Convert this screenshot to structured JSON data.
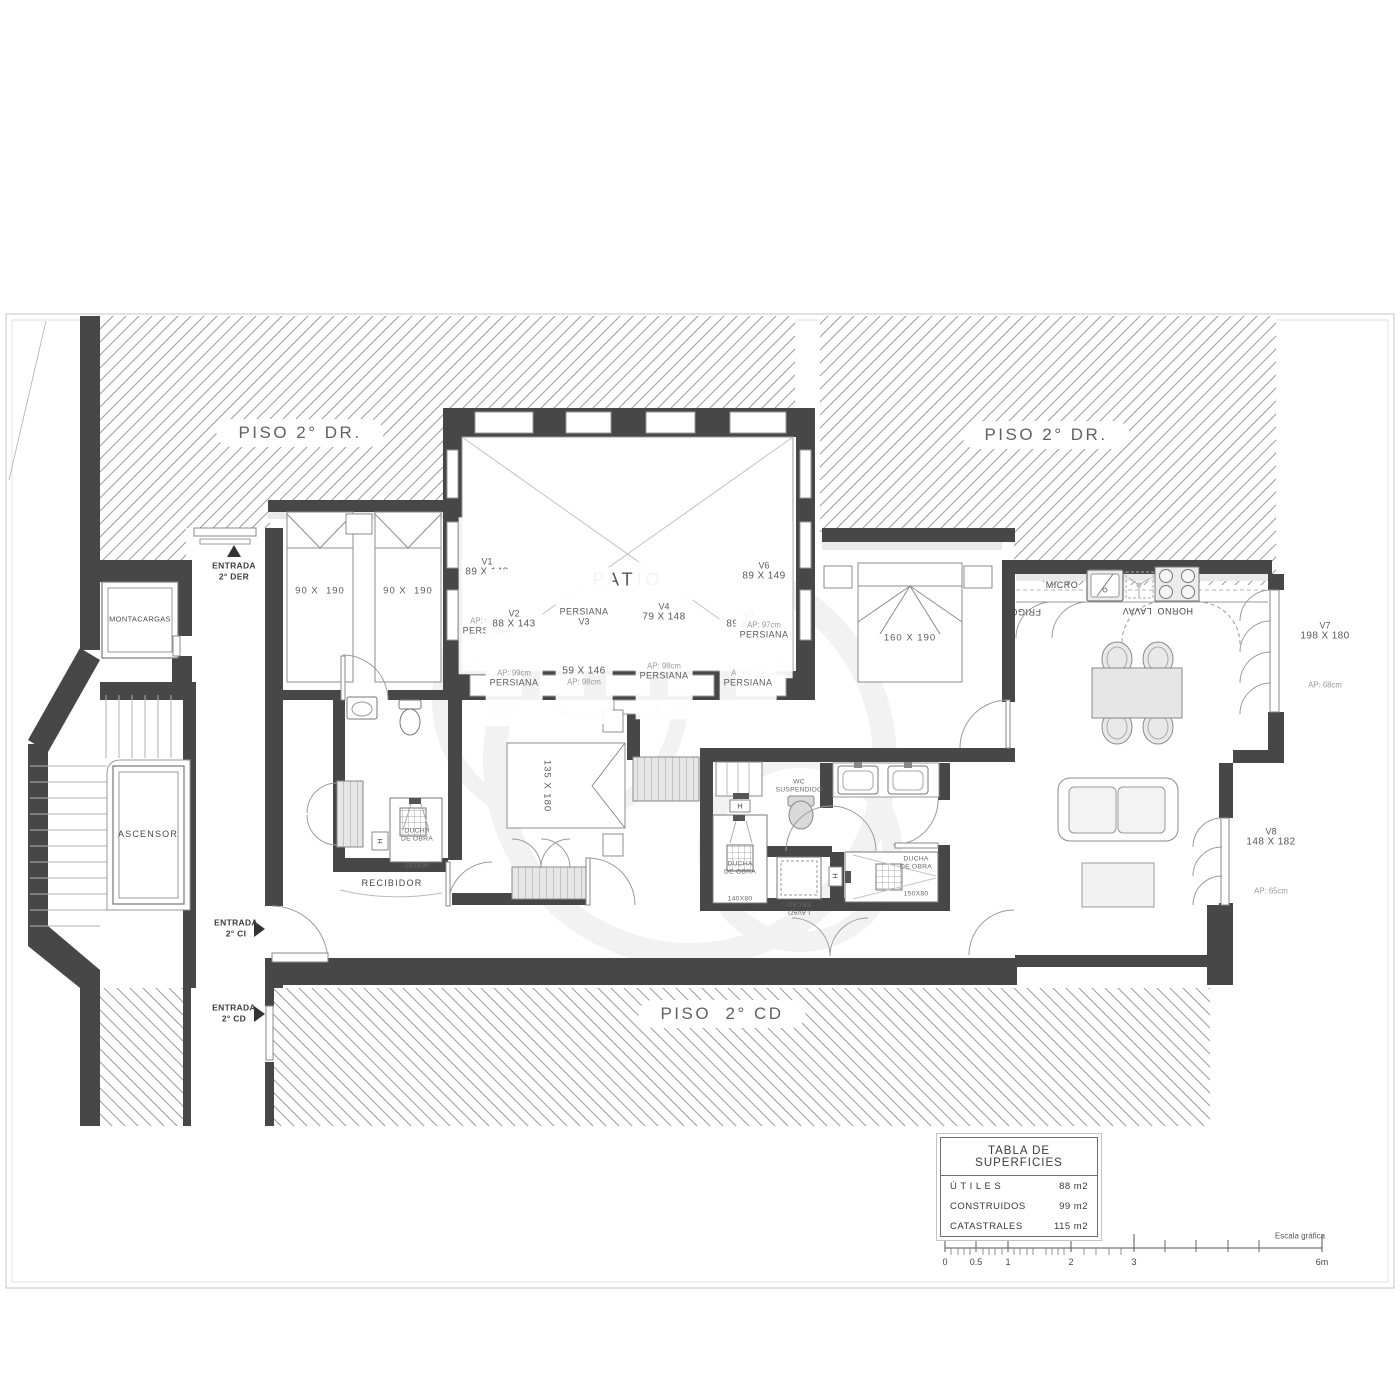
{
  "neighbors": {
    "top_left": "PISO 2° DR.",
    "top_right": "PISO 2° DR.",
    "bottom": "PISO  2° CD"
  },
  "core": {
    "montacargas": "MONTACARGAS",
    "ascensor": "ASCENSOR"
  },
  "entrances": {
    "der": {
      "line1": "ENTRADA",
      "line2": "2° DER"
    },
    "ci": {
      "line1": "ENTRADA",
      "line2": "2° CI"
    },
    "cd": {
      "line1": "ENTRADA",
      "line2": "2° CD"
    }
  },
  "rooms": {
    "patio": "PATIO",
    "recibidor": "RECIBIDOR"
  },
  "windows": {
    "v1": {
      "id": "V1",
      "size": "89 X 148",
      "ap": "AP: 97cm",
      "shutter": "PERSIANA"
    },
    "v2": {
      "id": "V2",
      "size": "88 X 143",
      "ap": "AP: 99cm",
      "shutter": "PERSIANA"
    },
    "v3": {
      "id": "V3",
      "size": "59 X 146",
      "ap": "AP: 98cm",
      "shutter": "PERSIANA"
    },
    "v4": {
      "id": "V4",
      "size": "79 X 148",
      "ap": "AP: 98cm",
      "shutter": "PERSIANA"
    },
    "v5": {
      "id": "V5",
      "size": "89 X 148",
      "ap": "AP: 98cm",
      "shutter": "PERSIANA"
    },
    "v6": {
      "id": "V6",
      "size": "89 X 149",
      "ap": "AP: 97cm",
      "shutter": "PERSIANA"
    },
    "v7": {
      "id": "V7",
      "size": "198 X 180",
      "ap": "AP: 68cm"
    },
    "v8": {
      "id": "V8",
      "size": "148 X 182",
      "ap": "AP: 65cm"
    }
  },
  "beds": {
    "single_left": "90 X  190",
    "single_right": "90 X  190",
    "middle": "135 X 180",
    "master": "160 X 190"
  },
  "kitchen": {
    "micro": "MICRO",
    "frigo": "FRIGO.",
    "lavav": "LAVAV",
    "horno": "HORNO"
  },
  "bathrooms": {
    "wc_suspendido": {
      "line1": "WC",
      "line2": "SUSPENDIDO"
    },
    "ducha_150x90": {
      "line1": "DUCHA",
      "line2": "DE OBRA",
      "line3": "150X90"
    },
    "ducha_140x80": {
      "line1": "DUCHA",
      "line2": "DE OBRA",
      "line3": "140X80"
    },
    "ducha_150x80": {
      "line1": "DUCHA",
      "line2": "DE OBRA",
      "line3": "150X80"
    },
    "lavadora": "LAVAD",
    "secadora": "SECAD",
    "towel_rail": "H"
  },
  "surface_table": {
    "title": "TABLA DE SUPERFICIES",
    "rows": [
      {
        "label": "Ú T I L E S",
        "value": "88 m2"
      },
      {
        "label": "CONSTRUIDOS",
        "value": "99 m2"
      },
      {
        "label": "CATASTRALES",
        "value": "115 m2"
      }
    ]
  },
  "scale_bar": {
    "caption": "Escala gráfica",
    "labels": [
      "0",
      "0.5",
      "1",
      "2",
      "3",
      "6m"
    ]
  }
}
